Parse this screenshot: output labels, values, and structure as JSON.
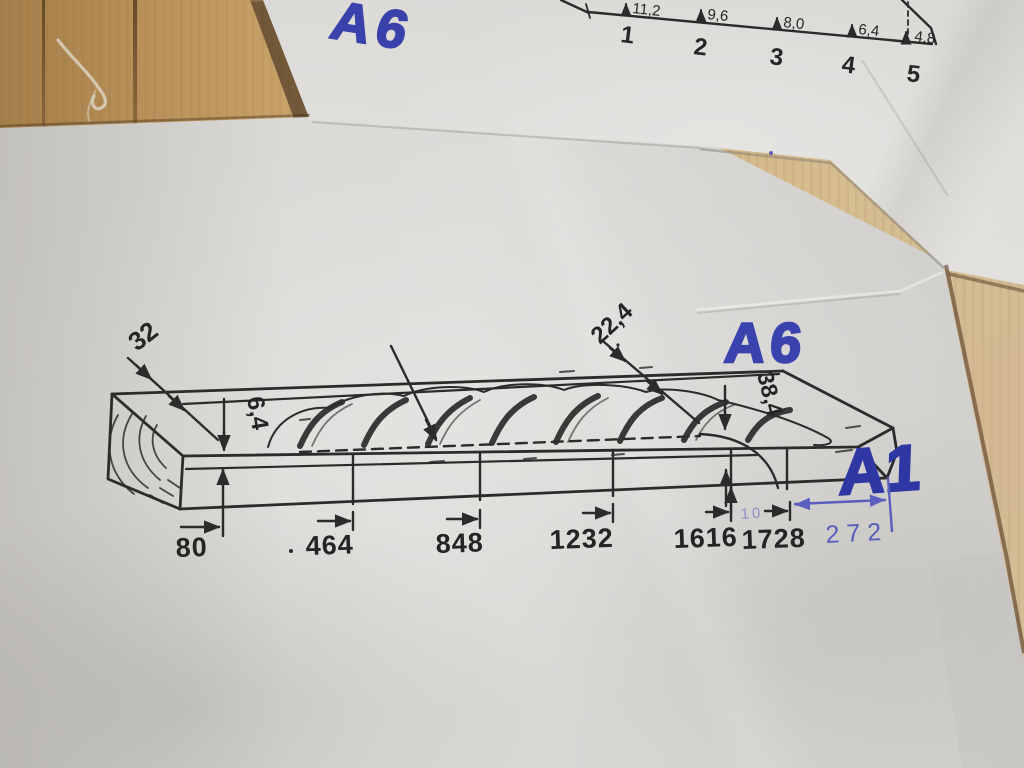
{
  "colors": {
    "ink_blue_marker": "#3a43ad",
    "ink_blue_pen": "#5a5fbe",
    "print_black": "#2b2b2b",
    "paper_grey": "#d8d7d4",
    "wood_tan": "#c49a60"
  },
  "top_sheet": {
    "handwritten_code": "A6",
    "diagram": {
      "depth_values": [
        "11,2",
        "9,6",
        "8,0",
        "6,4",
        "4,8"
      ],
      "station_numbers": [
        "1",
        "2",
        "3",
        "4",
        "5"
      ]
    }
  },
  "main_sheet": {
    "handwritten_code_a6": "A6",
    "handwritten_code_a1": "A1",
    "handwritten_length": "272",
    "handwritten_faint_note": "10",
    "diagram": {
      "width_dim": "32",
      "depth_dim": "6,4",
      "taper_dim": "22,4",
      "end_depth_dim": "38,4",
      "station_positions": [
        "80",
        "464",
        "848",
        "1232",
        "1616",
        "1728"
      ]
    }
  }
}
